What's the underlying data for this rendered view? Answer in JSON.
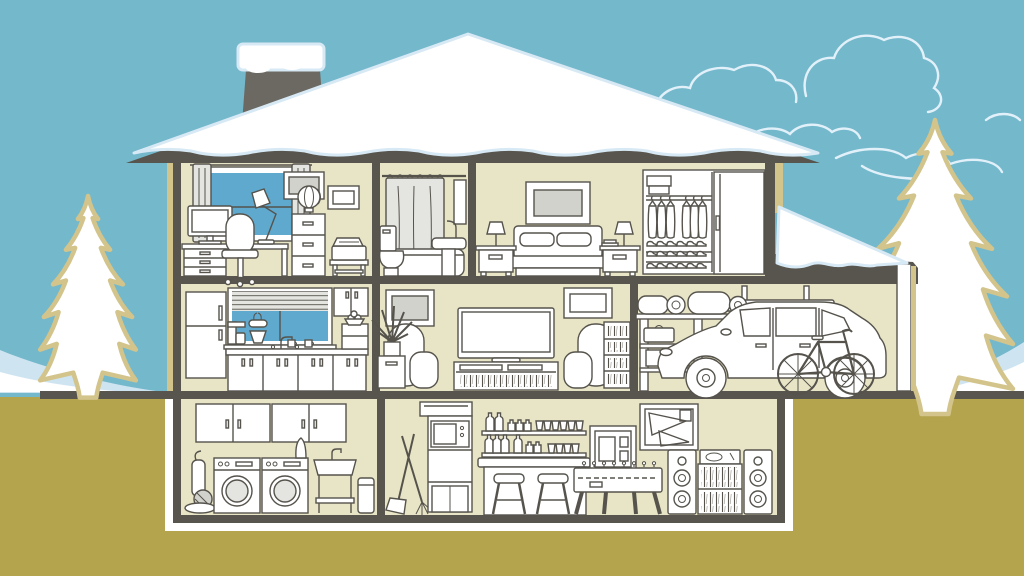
{
  "scene": {
    "title": "winter-house-cutaway-illustration",
    "season": "winter",
    "rooms": [
      {
        "name": "office",
        "floor": "upper",
        "items": [
          "desk",
          "computer-monitor",
          "office-chair",
          "desk-lamp",
          "window-with-curtains",
          "drawer-unit",
          "file-cabinet",
          "globe",
          "printer-stand",
          "wall-art"
        ]
      },
      {
        "name": "bathroom",
        "floor": "upper",
        "items": [
          "shower-rod",
          "shower-curtain",
          "bathtub",
          "toilet",
          "pedestal-sink",
          "wall-cabinet"
        ]
      },
      {
        "name": "bedroom",
        "floor": "upper",
        "items": [
          "bed",
          "pillows",
          "headboard",
          "nightstand-left",
          "nightstand-right",
          "table-lamps",
          "books",
          "wall-art",
          "closet",
          "storage-boxes",
          "hanging-clothes",
          "shoe-rack",
          "sliding-door"
        ]
      },
      {
        "name": "kitchen",
        "floor": "main",
        "items": [
          "refrigerator",
          "window-with-blinds",
          "faucet",
          "coffee-maker",
          "stand-mixer",
          "mugs",
          "base-cabinets",
          "upper-cabinet",
          "pantry-cabinet",
          "fruit-bowl"
        ]
      },
      {
        "name": "living-room",
        "floor": "main",
        "items": [
          "television",
          "media-console",
          "dvd-shelf",
          "armchair-left",
          "armchair-right",
          "bookshelf",
          "houseplant",
          "plant-stand",
          "wall-art"
        ]
      },
      {
        "name": "garage",
        "floor": "main",
        "items": [
          "hatchback-car",
          "bicycle",
          "storage-shelf",
          "duffel-bags",
          "sleeping-roll",
          "suitcase",
          "skis"
        ]
      },
      {
        "name": "laundry-room",
        "floor": "basement",
        "items": [
          "wall-cabinets",
          "vacuum-cleaner",
          "washer",
          "dryer",
          "ironing-board",
          "utility-sink",
          "trash-can"
        ]
      },
      {
        "name": "rec-room",
        "floor": "basement",
        "items": [
          "mop",
          "broom",
          "microwave-shelf",
          "storage-box",
          "bar-shelves",
          "bottles",
          "glasses",
          "bar-counter",
          "bar-stools",
          "shadow-box",
          "pennant-frame",
          "foosball-table",
          "speaker-left",
          "speaker-right",
          "record-shelf",
          "turntable"
        ]
      }
    ],
    "exterior": [
      "snowy-roof",
      "chimney",
      "chimney-snow-cap",
      "garage-pent-roof",
      "left-pine-tree",
      "right-pine-tree",
      "clouds",
      "snow-drift-left",
      "snow-drift-right",
      "ground"
    ]
  },
  "palette": {
    "sky": "#74b8cc",
    "ground": "#b3a44d",
    "wall": "#e8e4c6",
    "structure": "#57554e",
    "chimney": "#6b6962",
    "line": "#55534c",
    "white": "#ffffff",
    "snowShadow": "#d7e9f4",
    "windowBlue": "#5fa9cf",
    "tan": "#d2c48b",
    "lightGray": "#d2d2cc",
    "midGray": "#e4e4e0",
    "cloud": "#e2f1f9",
    "drift": "#cfe4f1"
  }
}
